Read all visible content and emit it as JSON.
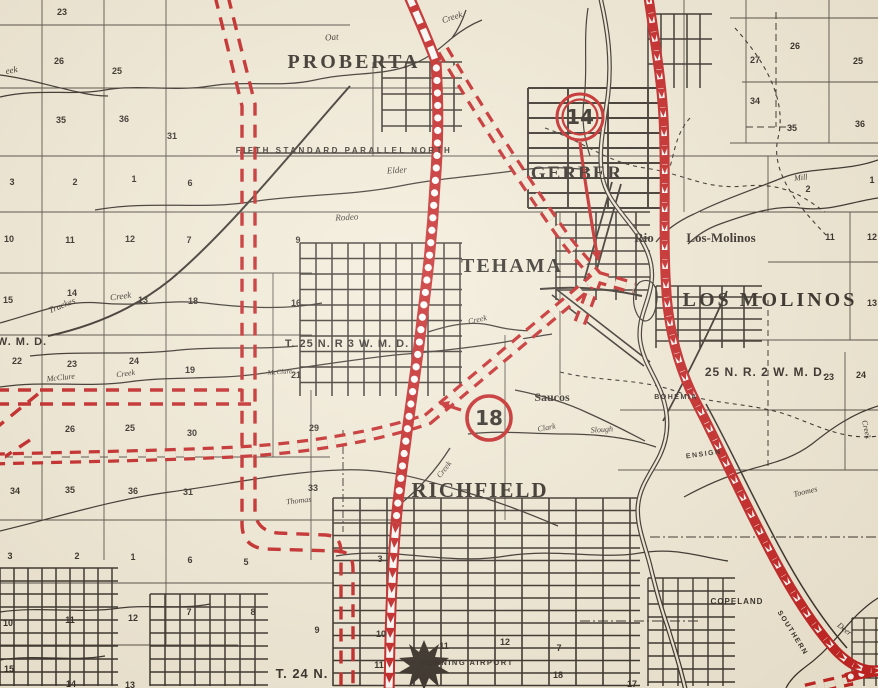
{
  "colors": {
    "paper": "#f2ebd9",
    "ink": "#2b2520",
    "route_red": "#c2181b"
  },
  "route_shields": [
    {
      "number": "14",
      "cx": 580,
      "cy": 117,
      "double_ring": true
    },
    {
      "number": "18",
      "cx": 489,
      "cy": 418,
      "double_ring": false
    }
  ],
  "labels": [
    {
      "name": "town-proberta",
      "text": "PROBERTA",
      "x": 354,
      "y": 68,
      "cls": "town",
      "size": 20,
      "ls": 3
    },
    {
      "name": "town-gerber",
      "text": "GERBER",
      "x": 577,
      "y": 179,
      "cls": "town",
      "size": 19,
      "ls": 2
    },
    {
      "name": "town-tehama",
      "text": "TEHAMA",
      "x": 512,
      "y": 272,
      "cls": "town",
      "size": 20,
      "ls": 2
    },
    {
      "name": "town-los-molinos",
      "text": "LOS MOLINOS",
      "x": 770,
      "y": 306,
      "cls": "town",
      "size": 20,
      "ls": 3
    },
    {
      "name": "town-richfield",
      "text": "RICHFIELD",
      "x": 480,
      "y": 497,
      "cls": "town",
      "size": 21,
      "ls": 2
    },
    {
      "name": "place-rio",
      "text": "Rio",
      "x": 644,
      "y": 242,
      "cls": "place",
      "size": 13
    },
    {
      "name": "place-los-molinos-small",
      "text": "Los-Molinos",
      "x": 721,
      "y": 242,
      "cls": "place",
      "size": 13
    },
    {
      "name": "place-saucos",
      "text": "Saucos",
      "x": 552,
      "y": 401,
      "cls": "place",
      "size": 12
    },
    {
      "name": "township-t25n-r3w",
      "text": "T. 25 N. R 3 W. M. D.",
      "x": 347,
      "y": 347,
      "cls": "township",
      "size": 11,
      "ls": 1
    },
    {
      "name": "township-25n-r2w",
      "text": "25 N. R. 2 W. M. D.",
      "x": 766,
      "y": 376,
      "cls": "township",
      "size": 12,
      "ls": 1
    },
    {
      "name": "township-t24n",
      "text": "T. 24 N.",
      "x": 302,
      "y": 678,
      "cls": "township",
      "size": 13,
      "ls": 1
    },
    {
      "name": "township-wmd",
      "text": "W. M. D.",
      "x": 22,
      "y": 345,
      "cls": "township",
      "size": 11,
      "ls": 1
    },
    {
      "name": "label-fifth-standard-parallel",
      "text": "FIFTH STANDARD PARALLEL NORTH",
      "x": 344,
      "y": 153,
      "cls": "smallcaps",
      "size": 8,
      "ls": 2.5
    },
    {
      "name": "label-corning-airport",
      "text": "CORNING AIRPORT",
      "x": 467,
      "y": 665,
      "cls": "smallcaps",
      "size": 7.5,
      "ls": 1.5
    },
    {
      "name": "label-copeland",
      "text": "COPELAND",
      "x": 737,
      "y": 604,
      "cls": "smallcaps",
      "size": 8,
      "ls": 1
    },
    {
      "name": "label-southern",
      "text": "SOUTHERN",
      "x": 791,
      "y": 634,
      "cls": "smallcaps",
      "size": 7,
      "ls": 1.5,
      "rot": 58
    },
    {
      "name": "label-bohemia",
      "text": "BOHEMIA",
      "x": 676,
      "y": 399,
      "cls": "smallcaps",
      "size": 7,
      "ls": 1.5
    },
    {
      "name": "label-ensign",
      "text": "ENSIGN",
      "x": 704,
      "y": 456,
      "cls": "smallcaps",
      "size": 7,
      "ls": 1.5,
      "rot": -8
    },
    {
      "name": "creek-oat",
      "text": "Oat",
      "x": 332,
      "y": 40,
      "cls": "creek",
      "size": 9,
      "rot": -5
    },
    {
      "name": "creek-oat-creek",
      "text": "Creek",
      "x": 453,
      "y": 20,
      "cls": "creek",
      "size": 9,
      "rot": -18
    },
    {
      "name": "creek-eek",
      "text": "eek",
      "x": 12,
      "y": 73,
      "cls": "creek",
      "size": 9,
      "rot": -10
    },
    {
      "name": "creek-elder",
      "text": "Elder",
      "x": 397,
      "y": 173,
      "cls": "creek",
      "size": 9,
      "rot": -3
    },
    {
      "name": "creek-rodeo",
      "text": "Rodeo",
      "x": 347,
      "y": 220,
      "cls": "creek",
      "size": 9,
      "rot": -3
    },
    {
      "name": "creek-truckes",
      "text": "Truckes",
      "x": 63,
      "y": 308,
      "cls": "creek",
      "size": 9,
      "rot": -22
    },
    {
      "name": "creek-truckes-creek",
      "text": "Creek",
      "x": 121,
      "y": 299,
      "cls": "creek",
      "size": 9,
      "rot": -8
    },
    {
      "name": "creek-mcclure",
      "text": "McClure",
      "x": 61,
      "y": 380,
      "cls": "creek",
      "size": 8,
      "rot": -6
    },
    {
      "name": "creek-mcclure-creek",
      "text": "Creek",
      "x": 126,
      "y": 376,
      "cls": "creek",
      "size": 8,
      "rot": -8
    },
    {
      "name": "creek-mcclure-2",
      "text": "McClure",
      "x": 280,
      "y": 374,
      "cls": "creek",
      "size": 7,
      "rot": -4
    },
    {
      "name": "creek-tehama",
      "text": "Creek",
      "x": 478,
      "y": 322,
      "cls": "creek",
      "size": 8,
      "rot": -12
    },
    {
      "name": "creek-clark",
      "text": "Clark",
      "x": 547,
      "y": 430,
      "cls": "creek",
      "size": 8,
      "rot": -10
    },
    {
      "name": "creek-slough",
      "text": "Slough",
      "x": 602,
      "y": 432,
      "cls": "creek",
      "size": 8,
      "rot": -4
    },
    {
      "name": "creek-thomas",
      "text": "Thomas",
      "x": 299,
      "y": 503,
      "cls": "creek",
      "size": 8,
      "rot": -6
    },
    {
      "name": "creek-thomas-creek",
      "text": "Creek",
      "x": 446,
      "y": 471,
      "cls": "creek",
      "size": 8,
      "rot": -52
    },
    {
      "name": "creek-mill",
      "text": "Mill",
      "x": 801,
      "y": 180,
      "cls": "creek",
      "size": 8,
      "rot": -6
    },
    {
      "name": "creek-toomes",
      "text": "Toomes",
      "x": 806,
      "y": 494,
      "cls": "creek",
      "size": 8,
      "rot": -14
    },
    {
      "name": "creek-toomes-creek",
      "text": "Creek",
      "x": 864,
      "y": 430,
      "cls": "creek",
      "size": 8,
      "rot": 78
    },
    {
      "name": "creek-deer",
      "text": "Deer",
      "x": 843,
      "y": 631,
      "cls": "creek",
      "size": 8,
      "rot": 38
    }
  ],
  "sections": [
    {
      "n": "23",
      "x": 62,
      "y": 15
    },
    {
      "n": "26",
      "x": 59,
      "y": 64
    },
    {
      "n": "25",
      "x": 117,
      "y": 74
    },
    {
      "n": "27",
      "x": -6,
      "y": 63
    },
    {
      "n": "34",
      "x": -6,
      "y": 122
    },
    {
      "n": "35",
      "x": 61,
      "y": 123
    },
    {
      "n": "36",
      "x": 124,
      "y": 122
    },
    {
      "n": "31",
      "x": 172,
      "y": 139
    },
    {
      "n": "3",
      "x": 12,
      "y": 185
    },
    {
      "n": "2",
      "x": 75,
      "y": 185
    },
    {
      "n": "1",
      "x": 134,
      "y": 182
    },
    {
      "n": "6",
      "x": 190,
      "y": 186
    },
    {
      "n": "10",
      "x": 9,
      "y": 242
    },
    {
      "n": "11",
      "x": 70,
      "y": 243
    },
    {
      "n": "12",
      "x": 130,
      "y": 242
    },
    {
      "n": "7",
      "x": 189,
      "y": 243
    },
    {
      "n": "9",
      "x": 298,
      "y": 243
    },
    {
      "n": "15",
      "x": 8,
      "y": 303
    },
    {
      "n": "14",
      "x": 72,
      "y": 296
    },
    {
      "n": "13",
      "x": 143,
      "y": 303
    },
    {
      "n": "18",
      "x": 193,
      "y": 304
    },
    {
      "n": "16",
      "x": 296,
      "y": 306
    },
    {
      "n": "22",
      "x": 17,
      "y": 364
    },
    {
      "n": "23",
      "x": 72,
      "y": 367
    },
    {
      "n": "24",
      "x": 134,
      "y": 364
    },
    {
      "n": "19",
      "x": 190,
      "y": 373
    },
    {
      "n": "21",
      "x": 296,
      "y": 378
    },
    {
      "n": "26",
      "x": 70,
      "y": 432
    },
    {
      "n": "25",
      "x": 130,
      "y": 431
    },
    {
      "n": "30",
      "x": 192,
      "y": 436
    },
    {
      "n": "29",
      "x": 314,
      "y": 431
    },
    {
      "n": "34",
      "x": 15,
      "y": 494
    },
    {
      "n": "35",
      "x": 70,
      "y": 493
    },
    {
      "n": "36",
      "x": 133,
      "y": 494
    },
    {
      "n": "31",
      "x": 188,
      "y": 495
    },
    {
      "n": "33",
      "x": 313,
      "y": 491
    },
    {
      "n": "3",
      "x": 10,
      "y": 559
    },
    {
      "n": "2",
      "x": 77,
      "y": 559
    },
    {
      "n": "1",
      "x": 133,
      "y": 560
    },
    {
      "n": "6",
      "x": 190,
      "y": 563
    },
    {
      "n": "5",
      "x": 246,
      "y": 565
    },
    {
      "n": "3",
      "x": 380,
      "y": 562
    },
    {
      "n": "10",
      "x": 8,
      "y": 626
    },
    {
      "n": "11",
      "x": 70,
      "y": 623
    },
    {
      "n": "12",
      "x": 133,
      "y": 621
    },
    {
      "n": "7",
      "x": 189,
      "y": 615
    },
    {
      "n": "8",
      "x": 253,
      "y": 615
    },
    {
      "n": "9",
      "x": 317,
      "y": 633
    },
    {
      "n": "10",
      "x": 381,
      "y": 637
    },
    {
      "n": "15",
      "x": 9,
      "y": 672
    },
    {
      "n": "14",
      "x": 71,
      "y": 687
    },
    {
      "n": "13",
      "x": 130,
      "y": 688
    },
    {
      "n": "11",
      "x": 379,
      "y": 668
    },
    {
      "n": "11",
      "x": 444,
      "y": 649
    },
    {
      "n": "12",
      "x": 505,
      "y": 645
    },
    {
      "n": "7",
      "x": 559,
      "y": 651
    },
    {
      "n": "18",
      "x": 558,
      "y": 678
    },
    {
      "n": "17",
      "x": 632,
      "y": 687
    },
    {
      "n": "26",
      "x": 795,
      "y": 49
    },
    {
      "n": "27",
      "x": 755,
      "y": 63
    },
    {
      "n": "25",
      "x": 858,
      "y": 64
    },
    {
      "n": "34",
      "x": 755,
      "y": 104
    },
    {
      "n": "35",
      "x": 792,
      "y": 131
    },
    {
      "n": "36",
      "x": 860,
      "y": 127
    },
    {
      "n": "2",
      "x": 808,
      "y": 192
    },
    {
      "n": "1",
      "x": 872,
      "y": 183
    },
    {
      "n": "11",
      "x": 830,
      "y": 240
    },
    {
      "n": "12",
      "x": 872,
      "y": 240
    },
    {
      "n": "13",
      "x": 872,
      "y": 306
    },
    {
      "n": "23",
      "x": 829,
      "y": 380
    },
    {
      "n": "24",
      "x": 861,
      "y": 378
    }
  ]
}
